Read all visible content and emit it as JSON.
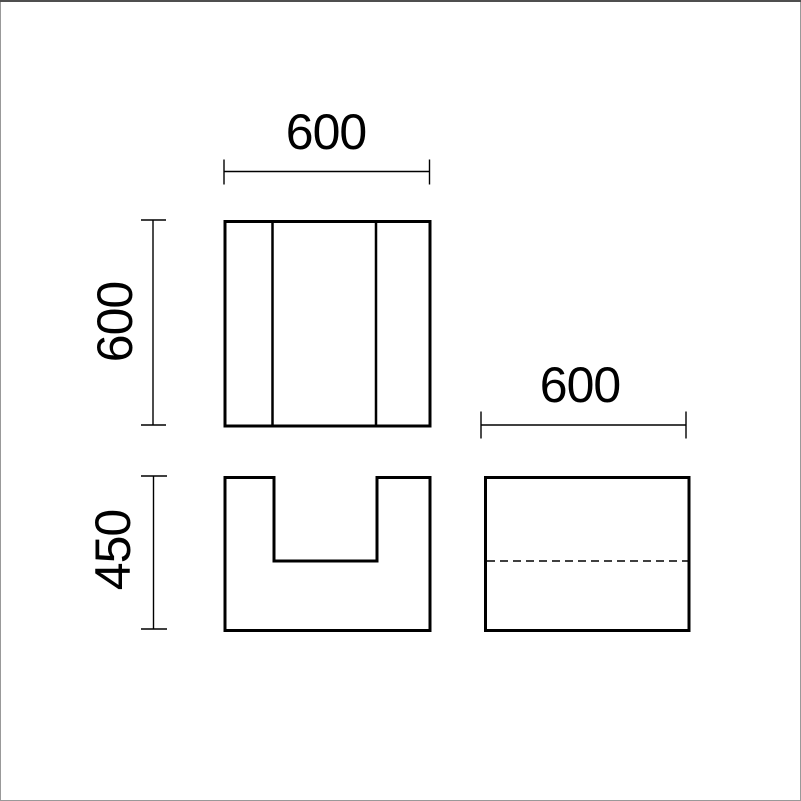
{
  "page": {
    "background": "#ffffff",
    "frame": {
      "top_color": "#4f4f4f",
      "side_color": "#999999"
    }
  },
  "drawing": {
    "line_color": "#000000",
    "dimensions": {
      "plan_width": {
        "label": "600"
      },
      "plan_depth": {
        "label": "600"
      },
      "front_height": {
        "label": "450"
      },
      "side_width": {
        "label": "600"
      }
    }
  }
}
